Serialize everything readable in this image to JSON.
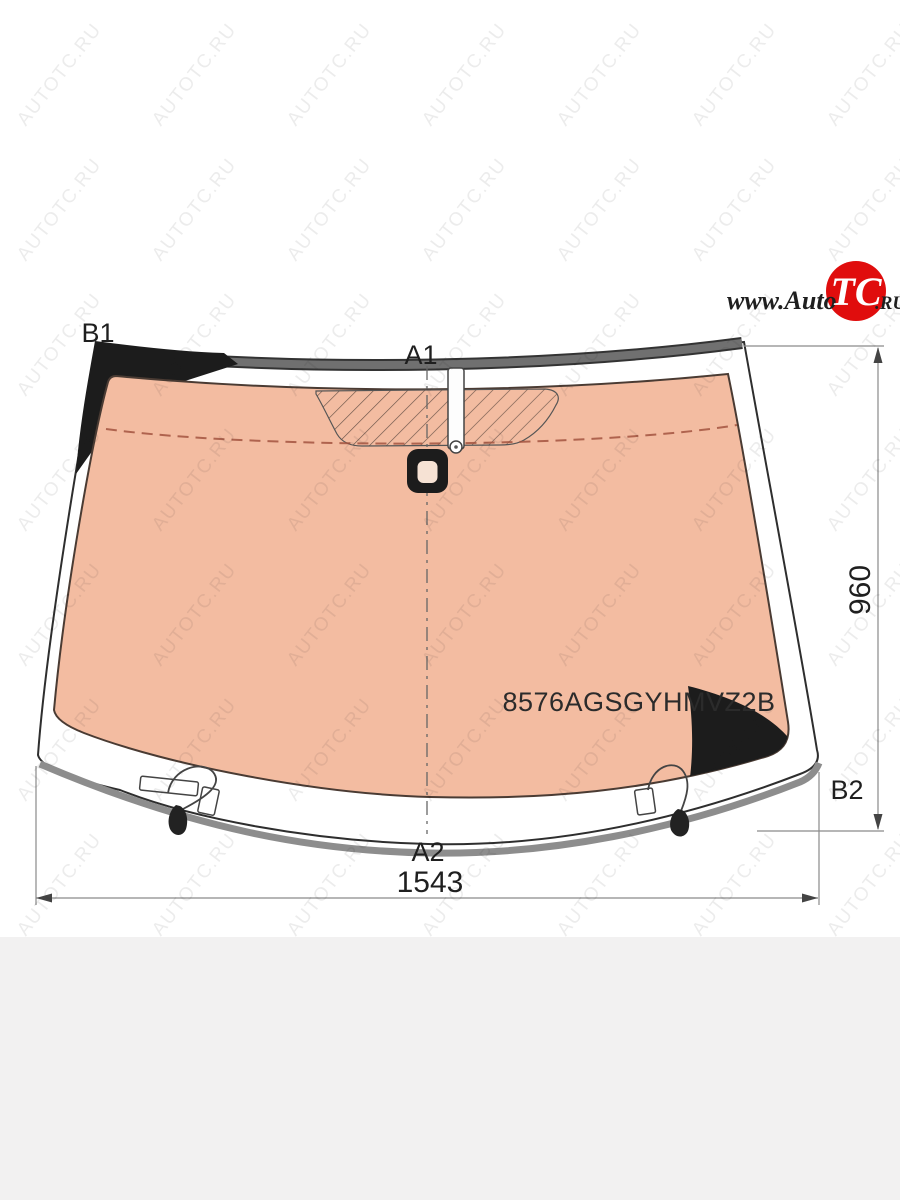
{
  "page": {
    "background": "#ffffff",
    "footer_band_color": "#f2f1f1"
  },
  "logo": {
    "prefix": "www.Auto",
    "badge": "TC",
    "suffix": ".RU",
    "badge_color": "#e00d0d"
  },
  "watermark": {
    "text": "AUTOTC.RU"
  },
  "diagram": {
    "part_number": "8576AGSGYHMVZ2B",
    "labels": {
      "top_left": "B1",
      "top_center": "A1",
      "bottom_center": "A2",
      "right_bottom": "B2"
    },
    "dimensions": {
      "width": "1543",
      "height": "960"
    },
    "colors": {
      "glass": "#f3bca1",
      "frit_black": "#1c1c1c",
      "molding_gray": "#707070",
      "hole_fill": "#f6e2d4"
    }
  }
}
